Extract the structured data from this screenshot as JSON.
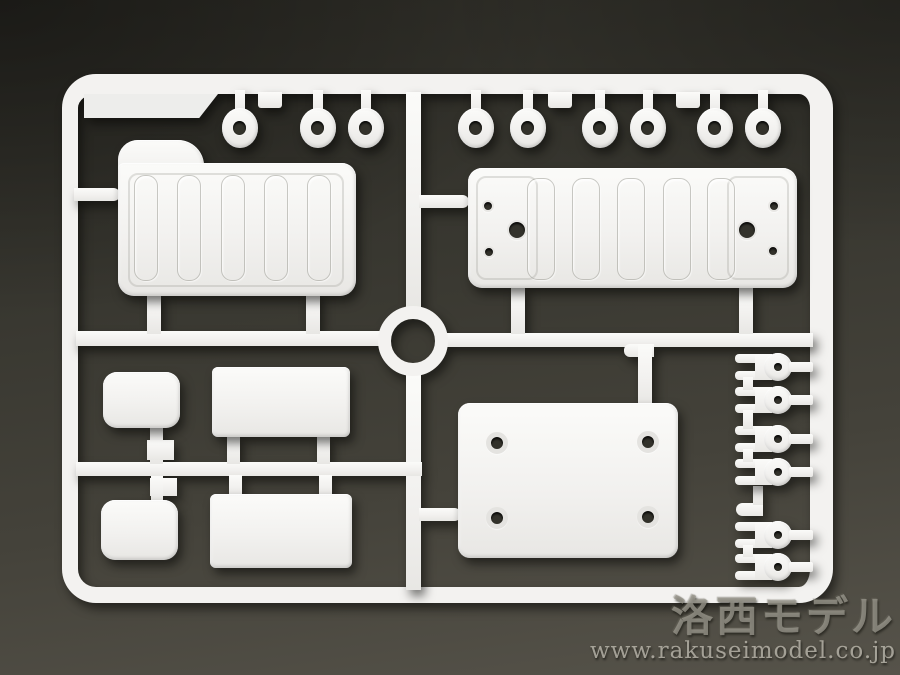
{
  "photo": {
    "subject": "white injection-molded model kit sprue with parts on dark gray backdrop"
  },
  "watermark": {
    "logo_text": "洛西モデル",
    "url_text": "www.rakuseimodel.co.jp"
  },
  "colors": {
    "background_dark": "#2c2b25",
    "background_light": "#56534a",
    "plastic_white": "#f3f2f0",
    "hole_dark": "#33322b",
    "watermark_gray": "#98968c"
  },
  "sprue": {
    "grommets": {
      "count": 9,
      "x_positions": [
        240,
        318,
        366,
        476,
        528,
        600,
        648,
        715,
        763
      ],
      "y_center": 128
    },
    "top_tabs_x": [
      270,
      560,
      688
    ],
    "canopy_panel": {
      "rib_count": 5,
      "rib_centers": [
        27,
        70,
        114,
        157,
        200
      ]
    },
    "bed_panel": {
      "rib_count": 5,
      "rib_centers": [
        72,
        117,
        162,
        208,
        252
      ],
      "small_holes": [
        [
          20,
          38
        ],
        [
          21,
          84
        ],
        [
          306,
          38
        ],
        [
          305,
          83
        ]
      ],
      "large_holes": [
        [
          49,
          62
        ],
        [
          279,
          62
        ]
      ]
    },
    "base_plate": {
      "hole_count": 4,
      "holes": [
        [
          39,
          40
        ],
        [
          190,
          39
        ],
        [
          39,
          115
        ],
        [
          190,
          114
        ]
      ]
    },
    "fork_parts": {
      "count": 6,
      "y_centers": [
        367,
        400,
        439,
        472,
        535,
        567
      ],
      "link_stubs": [
        [
          377,
          13
        ],
        [
          410,
          19
        ],
        [
          449,
          13
        ],
        [
          545,
          12
        ]
      ]
    }
  }
}
